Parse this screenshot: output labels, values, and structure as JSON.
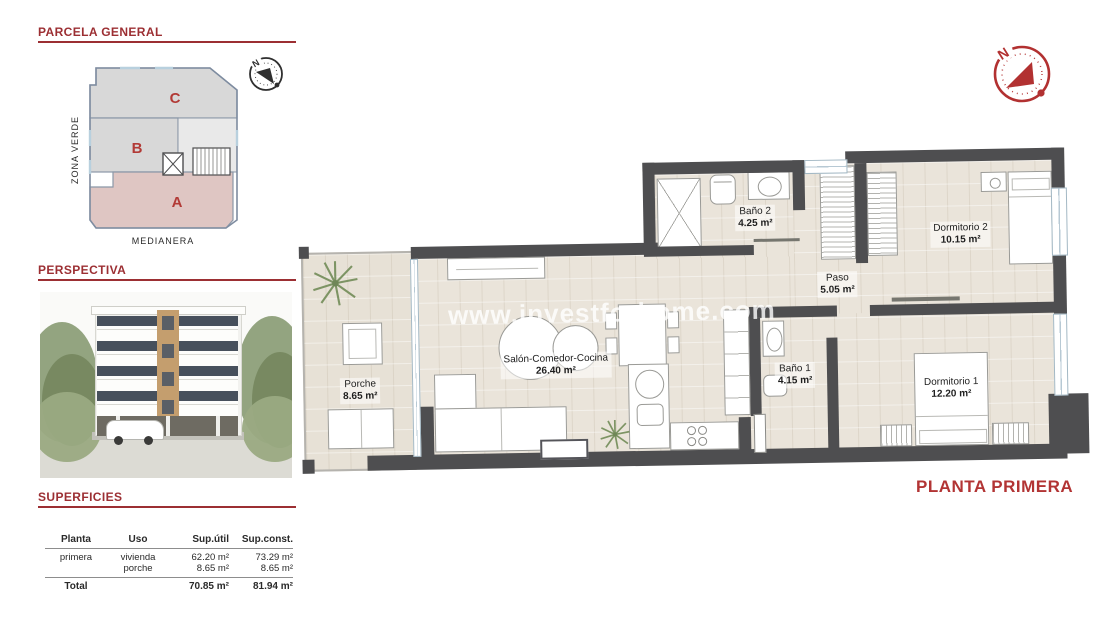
{
  "parcela": {
    "title": "PARCELA GENERAL",
    "zona_verde": "ZONA VERDE",
    "medianera": "MEDIANERA",
    "zone_a": "A",
    "zone_b": "B",
    "zone_c": "C",
    "compass_n": "N"
  },
  "perspectiva": {
    "title": "PERSPECTIVA"
  },
  "superficies": {
    "title": "SUPERFICIES",
    "headers": {
      "planta": "Planta",
      "uso": "Uso",
      "util": "Sup.útil",
      "const": "Sup.const."
    },
    "rows": [
      {
        "planta": "primera",
        "uso": "vivienda",
        "util": "62.20 m²",
        "const": "73.29 m²"
      },
      {
        "planta": "",
        "uso": "porche",
        "util": "8.65 m²",
        "const": "8.65 m²"
      }
    ],
    "total": {
      "label": "Total",
      "util": "70.85 m²",
      "const": "81.94 m²"
    }
  },
  "plan": {
    "title": "PLANTA PRIMERA",
    "watermark": "www.investforhome.com",
    "compass_n": "N",
    "rooms": {
      "porche": {
        "name": "Porche",
        "area": "8.65 m²"
      },
      "salon": {
        "name": "Salón-Comedor-Cocina",
        "area": "26.40 m²"
      },
      "bano2": {
        "name": "Baño 2",
        "area": "4.25 m²"
      },
      "paso": {
        "name": "Paso",
        "area": "5.05 m²"
      },
      "dorm2": {
        "name": "Dormitorio 2",
        "area": "10.15 m²"
      },
      "bano1": {
        "name": "Baño 1",
        "area": "4.15 m²"
      },
      "dorm1": {
        "name": "Dormitorio 1",
        "area": "12.20 m²"
      }
    }
  }
}
